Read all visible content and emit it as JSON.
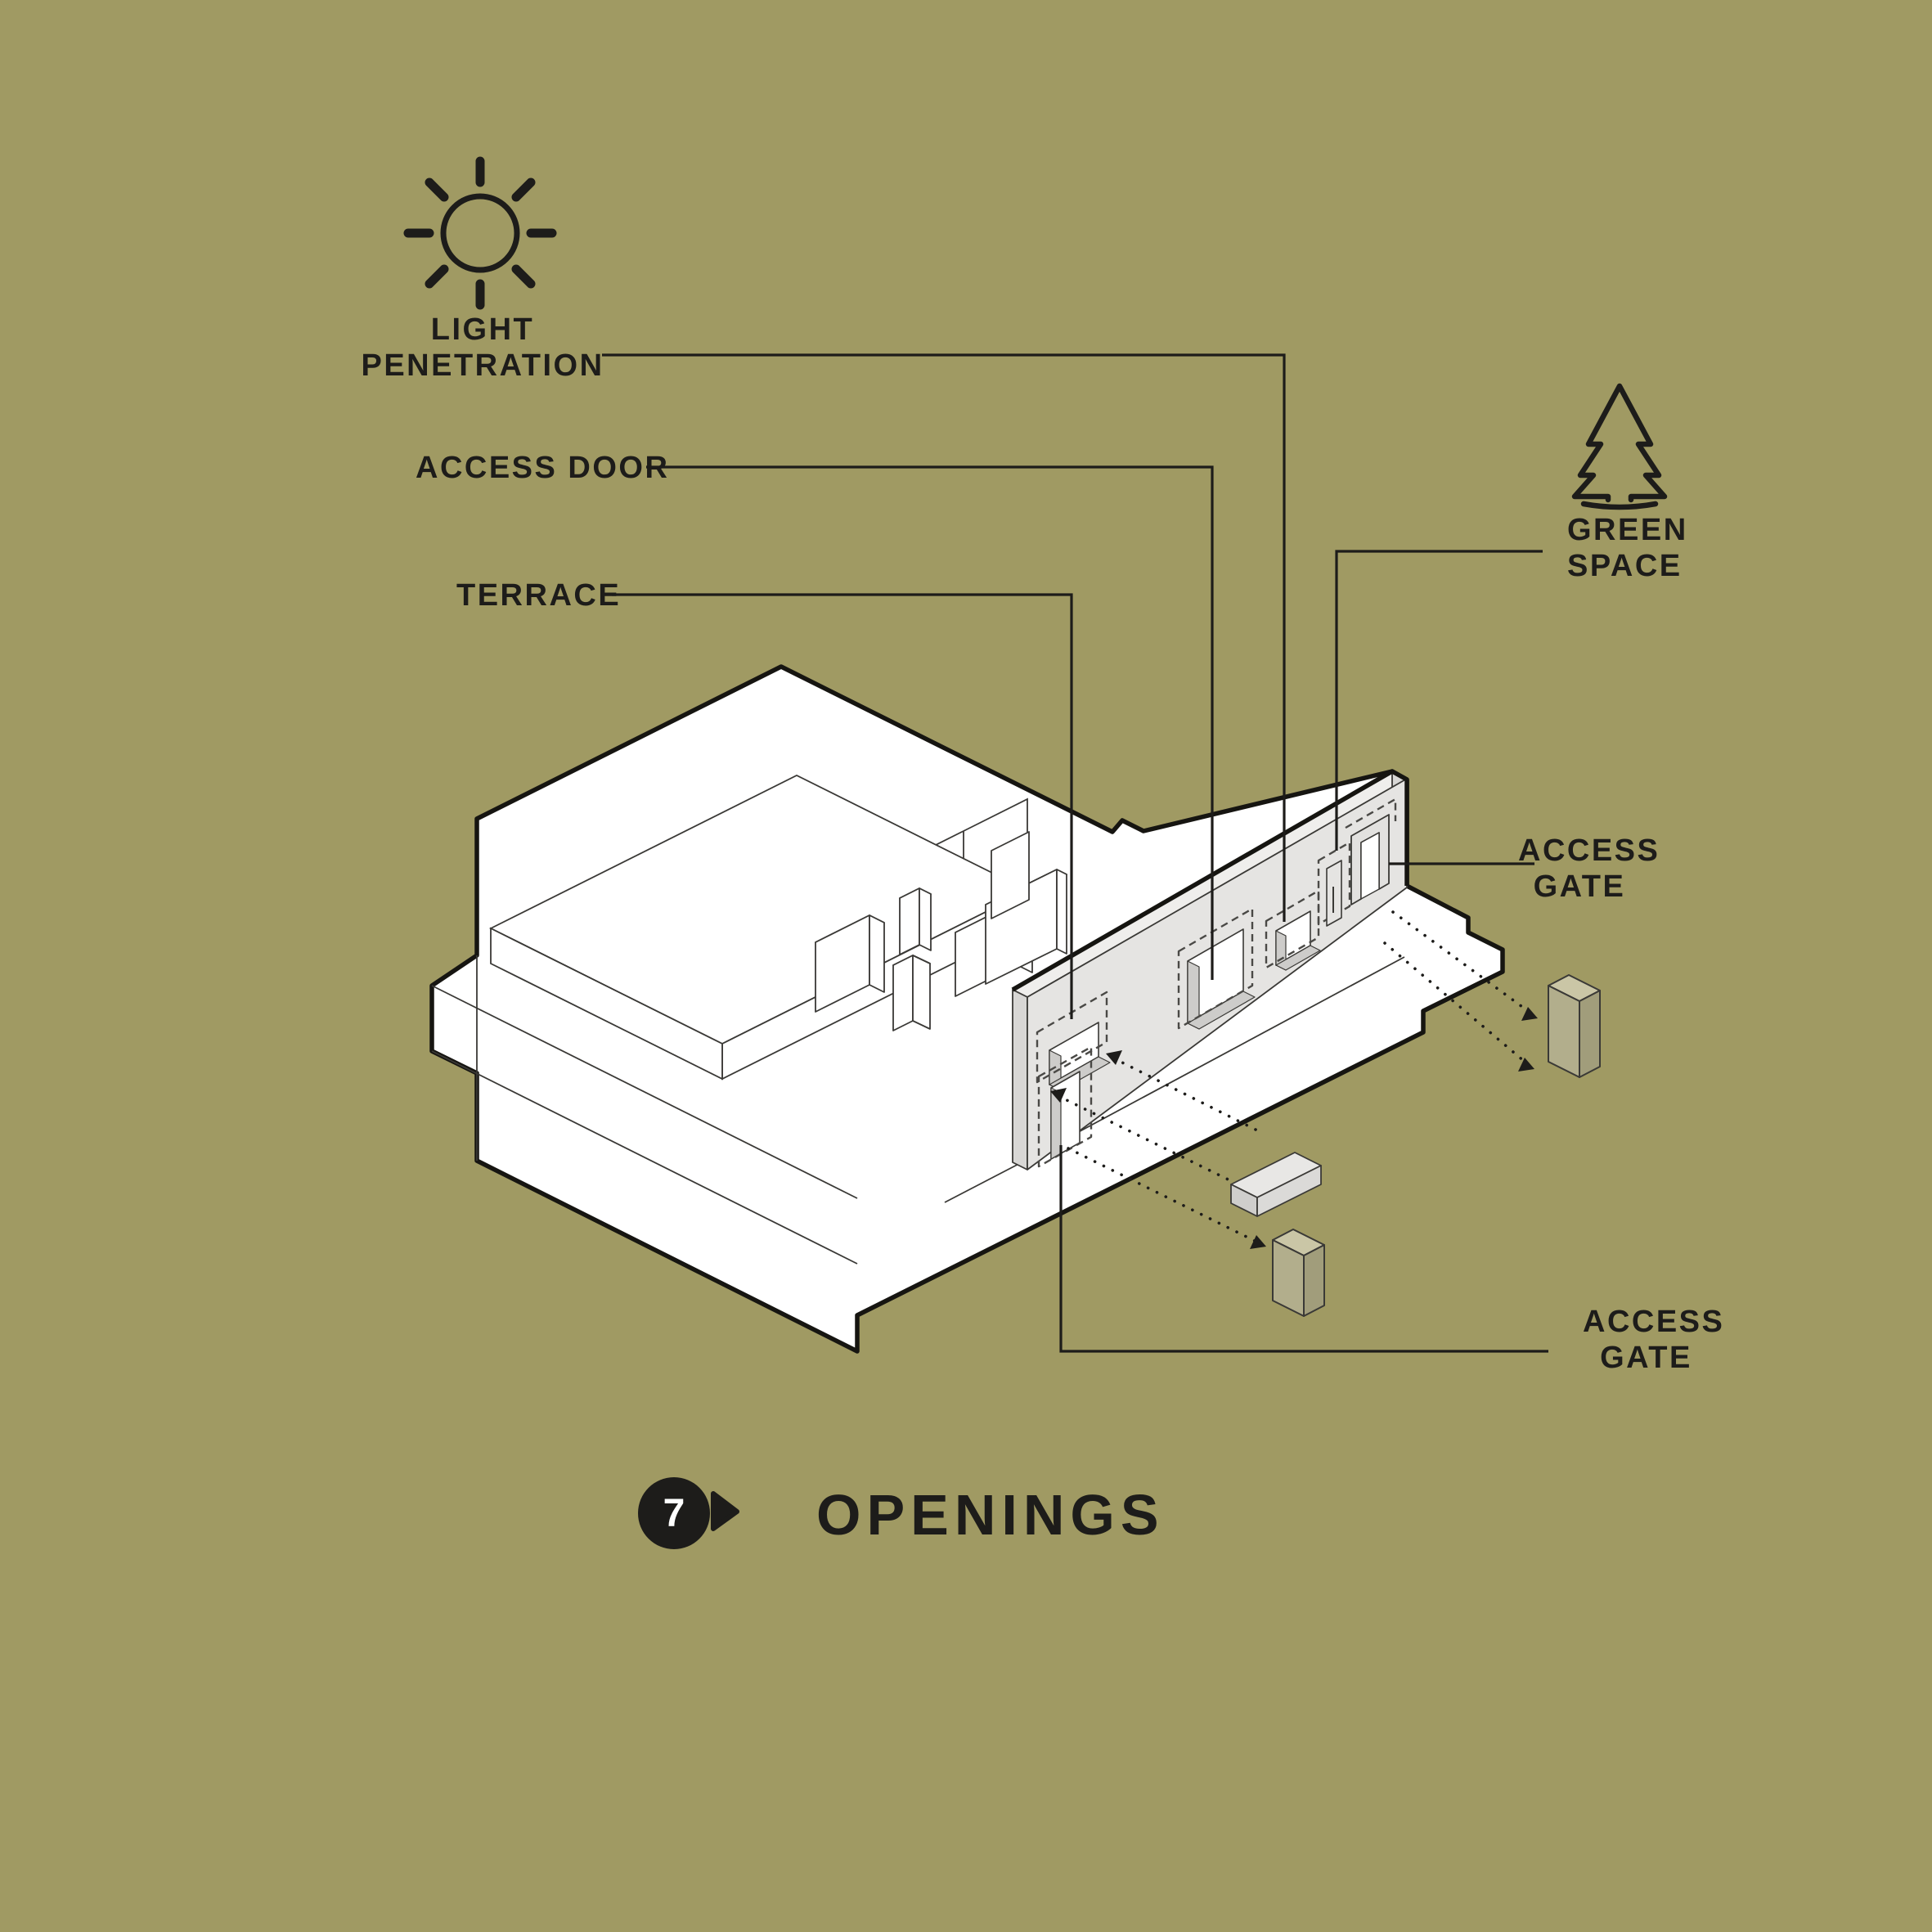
{
  "diagram": {
    "step_number": "7",
    "title": "OPENINGS",
    "type": "architectural axonometric concept diagram"
  },
  "legend": {
    "light_penetration": {
      "line1": "LIGHT",
      "line2": "PENETRATION",
      "icon": "sun-icon"
    },
    "access_door": {
      "label": "ACCESS DOOR"
    },
    "terrace": {
      "label": "TERRACE"
    },
    "green_space": {
      "line1": "GREEN",
      "line2": "SPACE",
      "icon": "pine-tree-icon"
    },
    "access_gate_right": {
      "line1": "ACCESS",
      "line2": "GATE"
    },
    "access_gate_bottom": {
      "line1": "ACCESS",
      "line2": "GATE"
    }
  },
  "colors": {
    "background_olive": "#a09a63",
    "ink_black": "#1d1c1a",
    "mass_white": "#ffffff",
    "wall_gray": "#e5e4e2",
    "wall_gray_side": "#d8d7d5",
    "wall_gray_top": "#efeeec",
    "reveal_gray": "#cdccca",
    "pillar_khaki_front": "#b2ae8c",
    "pillar_khaki_side": "#a19d7b",
    "pillar_khaki_top": "#cac6a6",
    "badge_text": "#ffffff"
  }
}
